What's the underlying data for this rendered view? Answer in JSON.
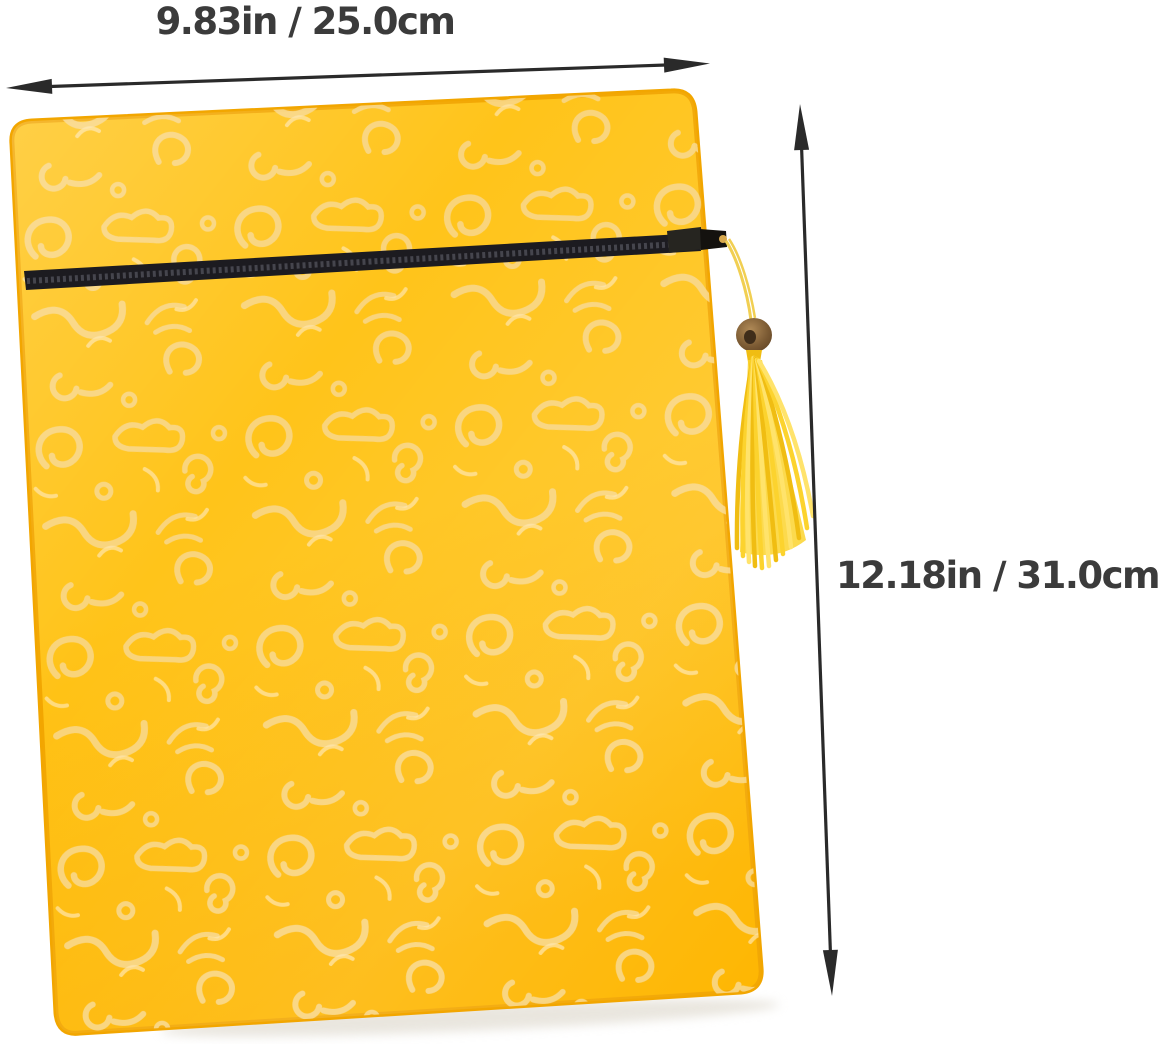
{
  "meta": {
    "description": "Product photo of a yellow silk brocade zippered pouch with tassel and measurement arrows",
    "background": "#ffffff"
  },
  "dimensions": {
    "width_label": "9.83in / 25.0cm",
    "height_label": "12.18in / 31.0cm"
  },
  "style": {
    "label_color": "#3b3b3b",
    "arrow_color": "#2a2a2a",
    "fabric_base": "#ffc41a",
    "fabric_deep": "#feb600",
    "fabric_edge": "#f2a600",
    "pattern_gold": "#f9d685",
    "pattern_light": "#ffe6ab",
    "zipper_black": "#1c1b20",
    "zipper_teeth": "#45454d",
    "tassel_yellow": "#fcd32e",
    "tassel_deep": "#f0bd12",
    "tassel_light": "#ffe36b",
    "cord_yellow": "#f1cf52",
    "bead_brown": "#7b5a33",
    "bead_dark": "#3f2d1a"
  }
}
